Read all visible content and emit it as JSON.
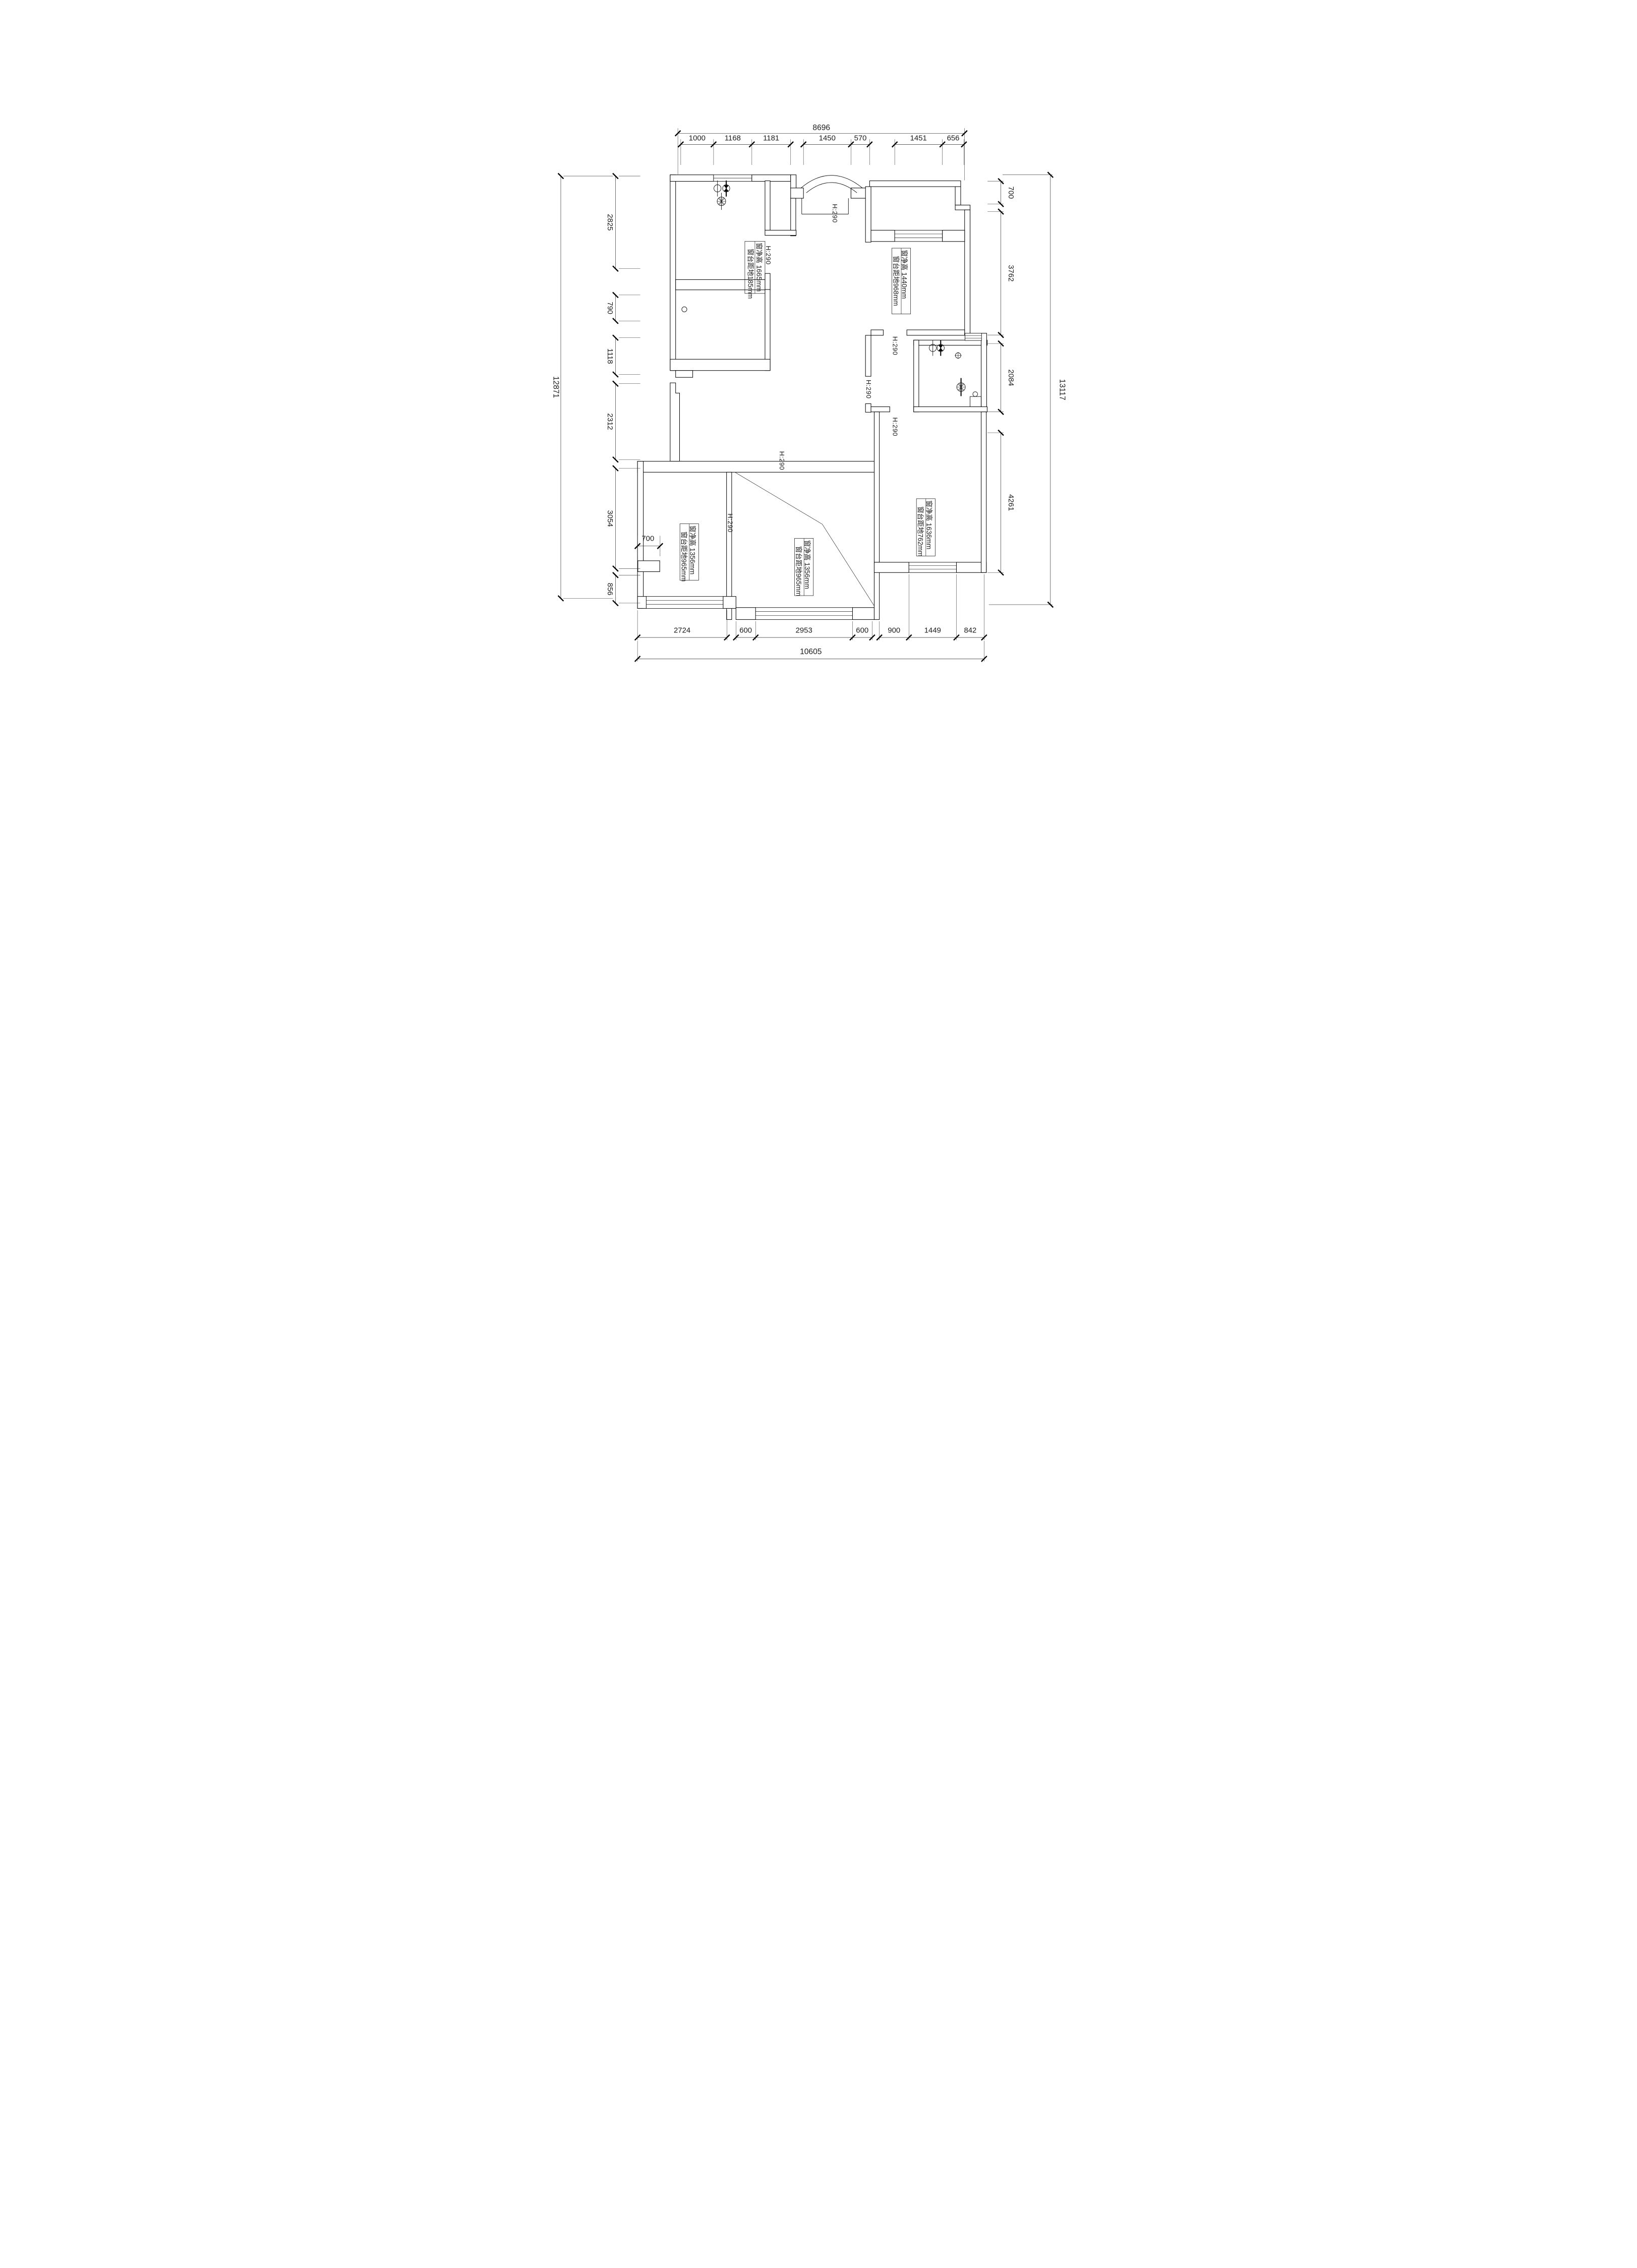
{
  "drawing": {
    "type": "architectural-floor-plan",
    "units": "mm",
    "background": "#ffffff",
    "line_color": "#000000",
    "text_color": "#1c1c1c"
  },
  "dims": {
    "top": {
      "overall": "8696",
      "segments": [
        "1000",
        "1168",
        "1181",
        "1450",
        "570",
        "1451",
        "656"
      ]
    },
    "bottom": {
      "overall": "10605",
      "segments": [
        "2724",
        "600",
        "2953",
        "600",
        "900",
        "1449",
        "842"
      ]
    },
    "left": {
      "overall": "12871",
      "segments": [
        "2825",
        "790",
        "1118",
        "2312",
        "3054",
        "856"
      ]
    },
    "right": {
      "overall": "13117",
      "segments": [
        "700",
        "3762",
        "2084",
        "4261"
      ]
    },
    "niche": {
      "width": "700"
    }
  },
  "beams": [
    "H:290",
    "H:290",
    "H:290",
    "H:290",
    "H:290",
    "H:290",
    "H:290"
  ],
  "windows": [
    {
      "location": "top-left-room",
      "clear_height": "窗净高 1665mm",
      "sill_height": "窗台距地185mm"
    },
    {
      "location": "top-right-room",
      "clear_height": "窗净高 1440mm",
      "sill_height": "窗台距地968mm"
    },
    {
      "location": "bottom-right-room",
      "clear_height": "窗净高 1636mm",
      "sill_height": "窗台距地762mm"
    },
    {
      "location": "bottom-middle-room",
      "clear_height": "窗净高 1356mm",
      "sill_height": "窗台距地965mm"
    },
    {
      "location": "bottom-left-room",
      "clear_height": "窗净高 1356mm",
      "sill_height": "窗台距地965mm"
    }
  ],
  "symbols": {
    "pendant_lamp": "circle-lamp",
    "ceiling_lamp": "half-filled-lamp",
    "exhaust_fan": "radial-fan",
    "floor_drain": "crossed-circle",
    "downlight": "small-circle"
  }
}
